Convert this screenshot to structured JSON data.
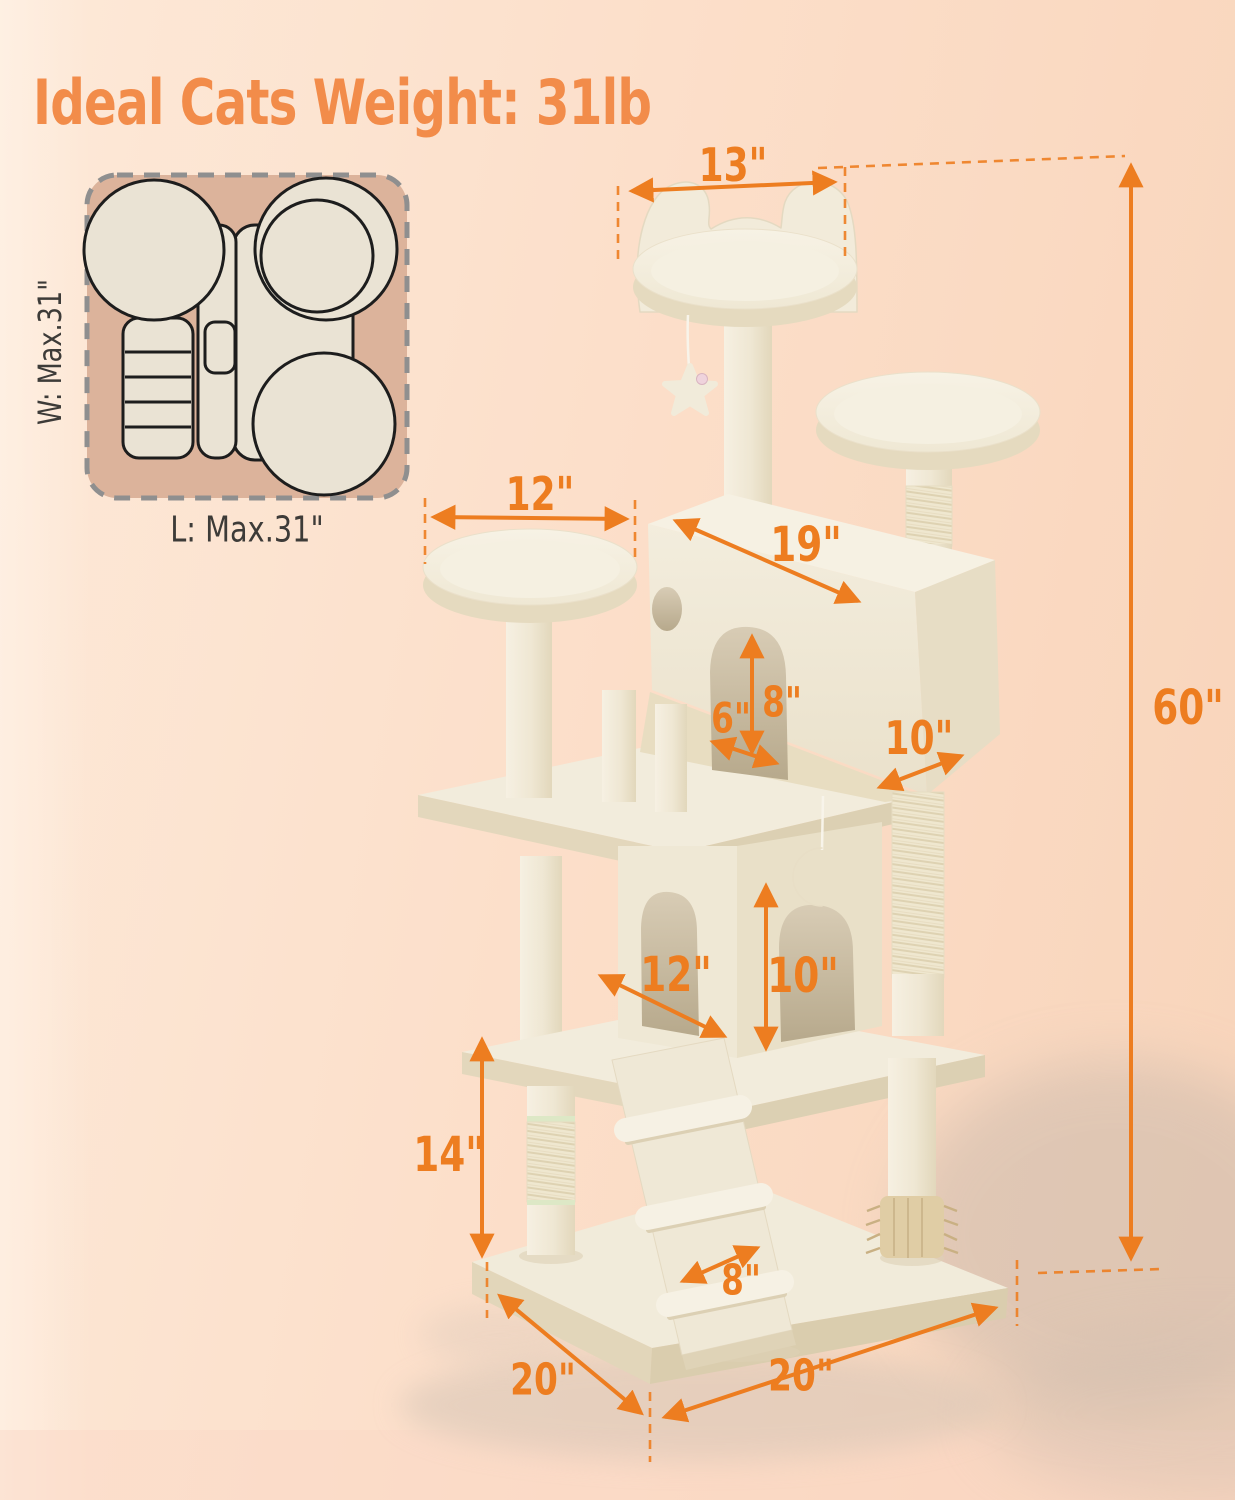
{
  "title": "Ideal Cats Weight: 31lb",
  "top_view": {
    "width_label": "W: Max.31\"",
    "length_label": "L: Max.31\""
  },
  "dimensions": {
    "top_perch_width": "13\"",
    "left_perch_diameter": "12\"",
    "condo_length": "19\"",
    "condo_door_width": "6\"",
    "condo_door_height": "8\"",
    "condo_depth": "10\"",
    "lower_condo_width": "12\"",
    "lower_condo_height": "10\"",
    "lower_section_height": "14\"",
    "ramp_width": "8\"",
    "base_side_left": "20\"",
    "base_side_right": "20\"",
    "total_height": "60\""
  },
  "colors": {
    "bg_start": "#fde9d8",
    "bg_mid": "#fcdfca",
    "bg_end": "#f8d4ba",
    "accent_orange": "#ed7d20",
    "title_orange": "#f28c4a",
    "label_dark": "#3d3b38",
    "product_cream": "#f2ecdc",
    "inset_panel": "#dcb39b",
    "inset_shape_fill": "#eae3d4",
    "shadow_gray": "#c7b7aa"
  }
}
